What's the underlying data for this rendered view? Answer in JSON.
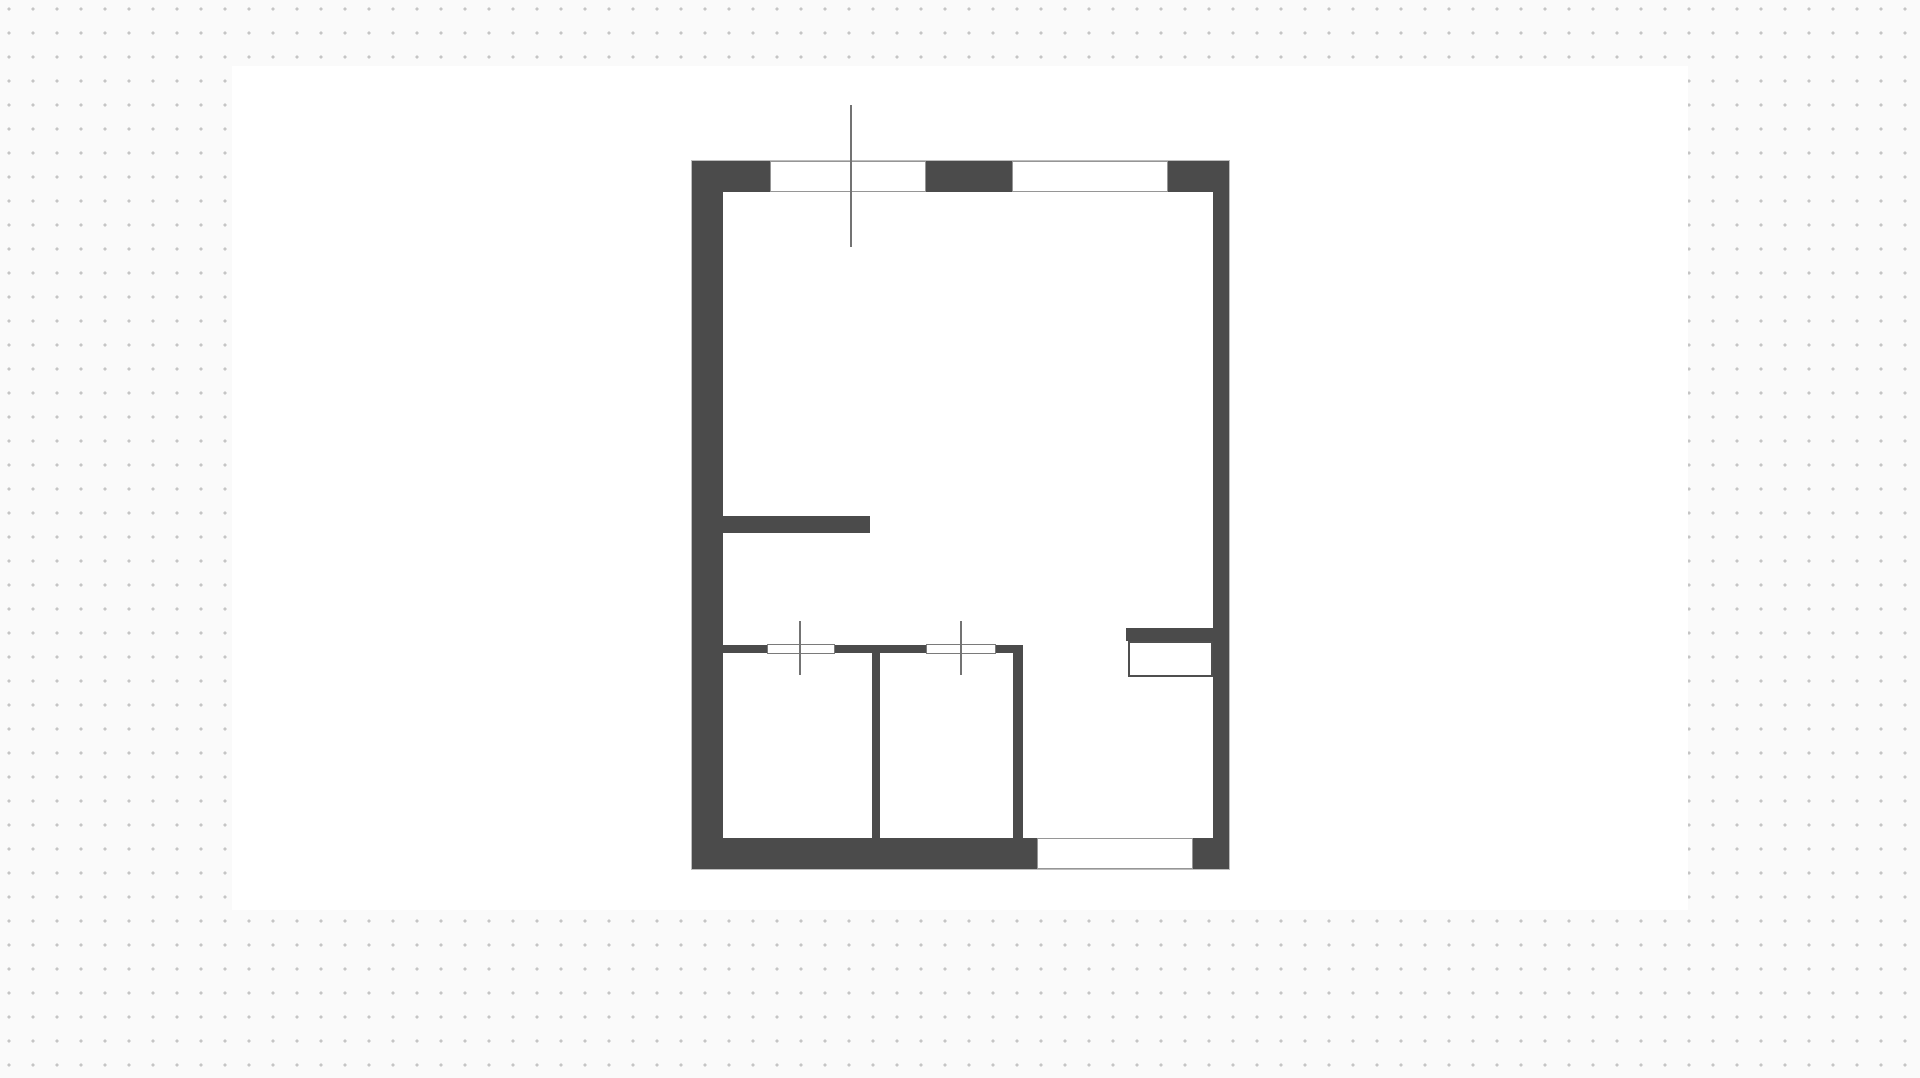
{
  "canvas": {
    "background_color": "#fafafa",
    "dot_color": "#c5c5c5",
    "dot_spacing_px": 24,
    "artboard": {
      "name": "artboard",
      "x": 232,
      "y": 66,
      "w": 1456,
      "h": 844
    }
  },
  "palette": {
    "background_color": "#fafafa",
    "dot_color": "#c5c5c5",
    "white": "#ffffff",
    "wall": "#4b4b4b",
    "window_border": "#969696",
    "opening_border": "#7a7a7a",
    "line": "#737373",
    "plan_outline": "#bdbdbd",
    "fixture_border": "#4f4f4f"
  },
  "floor_plan": {
    "bounds": {
      "name": "plan-outline",
      "x": 691,
      "y": 160,
      "w": 539,
      "h": 710
    },
    "walls": [
      {
        "name": "wall-exterior-top",
        "x": 692,
        "y": 161,
        "w": 537,
        "h": 31
      },
      {
        "name": "wall-exterior-left",
        "x": 692,
        "y": 161,
        "w": 31,
        "h": 708
      },
      {
        "name": "wall-exterior-right",
        "x": 1213,
        "y": 161,
        "w": 16,
        "h": 708
      },
      {
        "name": "wall-exterior-bottom",
        "x": 692,
        "y": 838,
        "w": 537,
        "h": 31
      },
      {
        "name": "wall-interior-stub-left",
        "x": 723,
        "y": 516,
        "w": 147,
        "h": 17
      },
      {
        "name": "wall-interior-horizontal",
        "x": 723,
        "y": 645,
        "w": 300,
        "h": 8
      },
      {
        "name": "wall-interior-vertical-1",
        "x": 872,
        "y": 645,
        "w": 8,
        "h": 193
      },
      {
        "name": "wall-interior-vertical-2",
        "x": 1013,
        "y": 645,
        "w": 10,
        "h": 193
      },
      {
        "name": "fixture-counter-bar",
        "x": 1126,
        "y": 628,
        "w": 87,
        "h": 13
      }
    ],
    "windows": [
      {
        "name": "window-top-left",
        "x": 770,
        "y": 161,
        "w": 156,
        "h": 31
      },
      {
        "name": "window-top-right",
        "x": 1012,
        "y": 161,
        "w": 156,
        "h": 31
      },
      {
        "name": "window-bottom",
        "x": 1037,
        "y": 838,
        "w": 156,
        "h": 31
      }
    ],
    "door_openings": [
      {
        "name": "door-opening-1",
        "x": 767,
        "y": 644,
        "w": 68,
        "h": 10
      },
      {
        "name": "door-opening-2",
        "x": 926,
        "y": 644,
        "w": 70,
        "h": 10
      }
    ],
    "lines": [
      {
        "name": "door-marker-1",
        "x": 799,
        "y": 621,
        "w": 2,
        "h": 54
      },
      {
        "name": "door-marker-2",
        "x": 960,
        "y": 621,
        "w": 2,
        "h": 54
      },
      {
        "name": "guide-line",
        "x": 850,
        "y": 105,
        "w": 1.5,
        "h": 142
      }
    ],
    "fixtures": [
      {
        "name": "fixture-counter-box",
        "x": 1128,
        "y": 641,
        "w": 85,
        "h": 36
      }
    ]
  }
}
